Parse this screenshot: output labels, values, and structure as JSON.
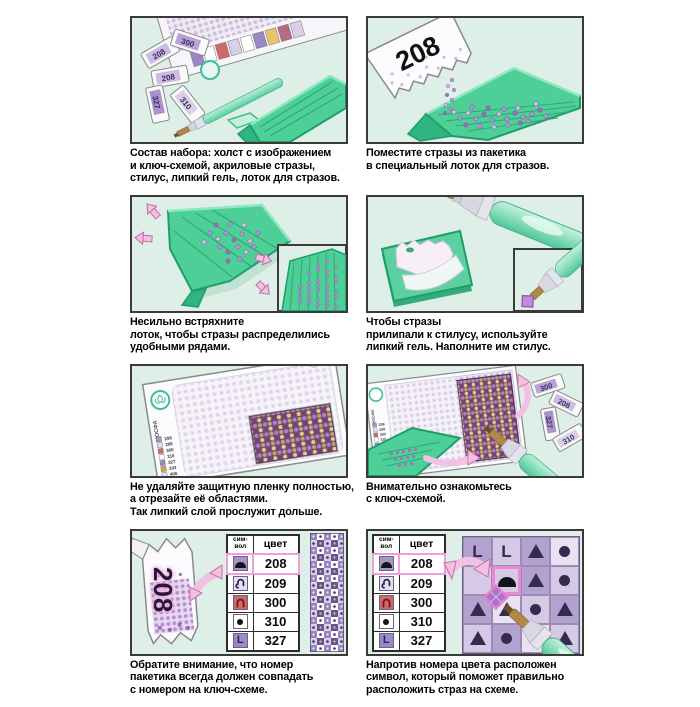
{
  "page": {
    "language": "ru",
    "background": "#ffffff",
    "kind": "diamond-mosaic-instructions"
  },
  "colors": {
    "panel_bg": "#ddefe7",
    "panel_border": "#3a3a3a",
    "tray_green": "#4ecf97",
    "tray_edge": "#1d9e6b",
    "stylus_teal": "#8ce0c2",
    "bead_purple": "#b795cf",
    "arrow_pink": "#f3bfe2",
    "highlight_pink": "#ee9ed8"
  },
  "steps": [
    {
      "id": 1,
      "caption": "Состав набора: холст с изображением\nи ключ-схемой, акриловые стразы,\nстилус, липкий гель, лоток для стразов."
    },
    {
      "id": 2,
      "caption": "Поместите стразы из пакетика\nв специальный лоток для стразов."
    },
    {
      "id": 3,
      "caption": "Несильно встряхните\nлоток, чтобы стразы распределились\nудобными рядами."
    },
    {
      "id": 4,
      "caption": "Чтобы стразы\nприлипали к стилусу, используйте\nлипкий гель. Наполните им стилус."
    },
    {
      "id": 5,
      "caption": "Не удаляйте защитную пленку полностью,\nа отрезайте её областями.\nТак липкий слой прослужит дольше."
    },
    {
      "id": 6,
      "caption": "Внимательно ознакомьтесь\nс ключ-схемой."
    },
    {
      "id": 7,
      "caption": "Обратите внимание, что номер\nпакетика всегда должен совпадать\nс номером на ключ-схеме."
    },
    {
      "id": 8,
      "caption": "Напротив номера цвета расположен\nсимвол, который поможет правильно\nрасположить страз на схеме."
    }
  ],
  "packet_number": "208",
  "kit_packets": [
    "208",
    "300",
    "208",
    "327",
    "310"
  ],
  "scheme_packets": [
    "300",
    "208",
    "327",
    "310"
  ],
  "brand": "МОСФА",
  "key_table": {
    "header_symbol": "сим-\nвол",
    "header_color": "цвет",
    "rows": [
      {
        "symbol": "dome-icon",
        "color_num": "208",
        "highlighted": true
      },
      {
        "symbol": "hook-icon",
        "color_num": "209",
        "highlighted": false
      },
      {
        "symbol": "arch-icon",
        "color_num": "300",
        "highlighted": false
      },
      {
        "symbol": "dot-icon",
        "color_num": "310",
        "highlighted": false
      },
      {
        "symbol": "letter-l-icon",
        "color_num": "327",
        "highlighted": false
      }
    ]
  },
  "mini_key_numbers": [
    "208",
    "209",
    "300",
    "310",
    "327",
    "333",
    "406",
    "550"
  ],
  "letter_l": "L",
  "scheme_grid": {
    "highlight_cell": [
      1,
      1
    ],
    "rows": [
      [
        "letter-l",
        "letter-l",
        "triangle",
        "dot"
      ],
      [
        "empty",
        "dome",
        "triangle",
        "dot"
      ],
      [
        "triangle",
        "triangle",
        "dot",
        "triangle"
      ],
      [
        "triangle",
        "dot",
        "letter-l",
        "triangle"
      ]
    ]
  }
}
